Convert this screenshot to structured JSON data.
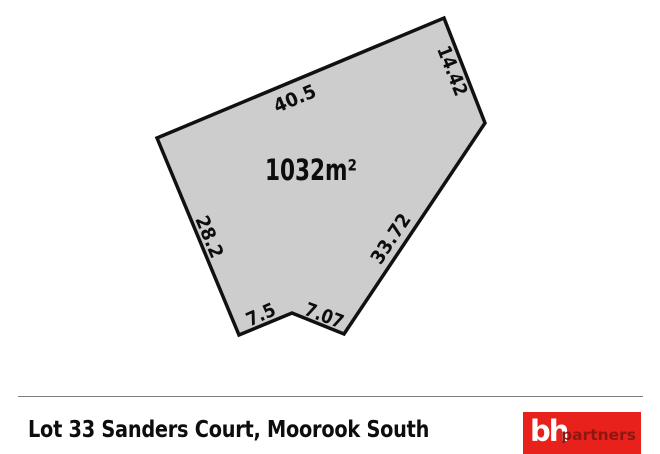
{
  "diagram": {
    "area_label": "1032m²",
    "dimensions": {
      "top": "40.5",
      "top_right": "14.42",
      "right": "33.72",
      "bottom_right": "7.07",
      "bottom_left": "7.5",
      "left": "28.2"
    },
    "colors": {
      "lot_fill": "#cdcdcd",
      "lot_stroke": "#111111"
    }
  },
  "footer": {
    "address": "Lot 33 Sanders Court, Moorook South",
    "logo": {
      "prefix": "bh",
      "suffix": "partners",
      "background": "#e8211c",
      "suffix_color": "#8f1712"
    }
  }
}
